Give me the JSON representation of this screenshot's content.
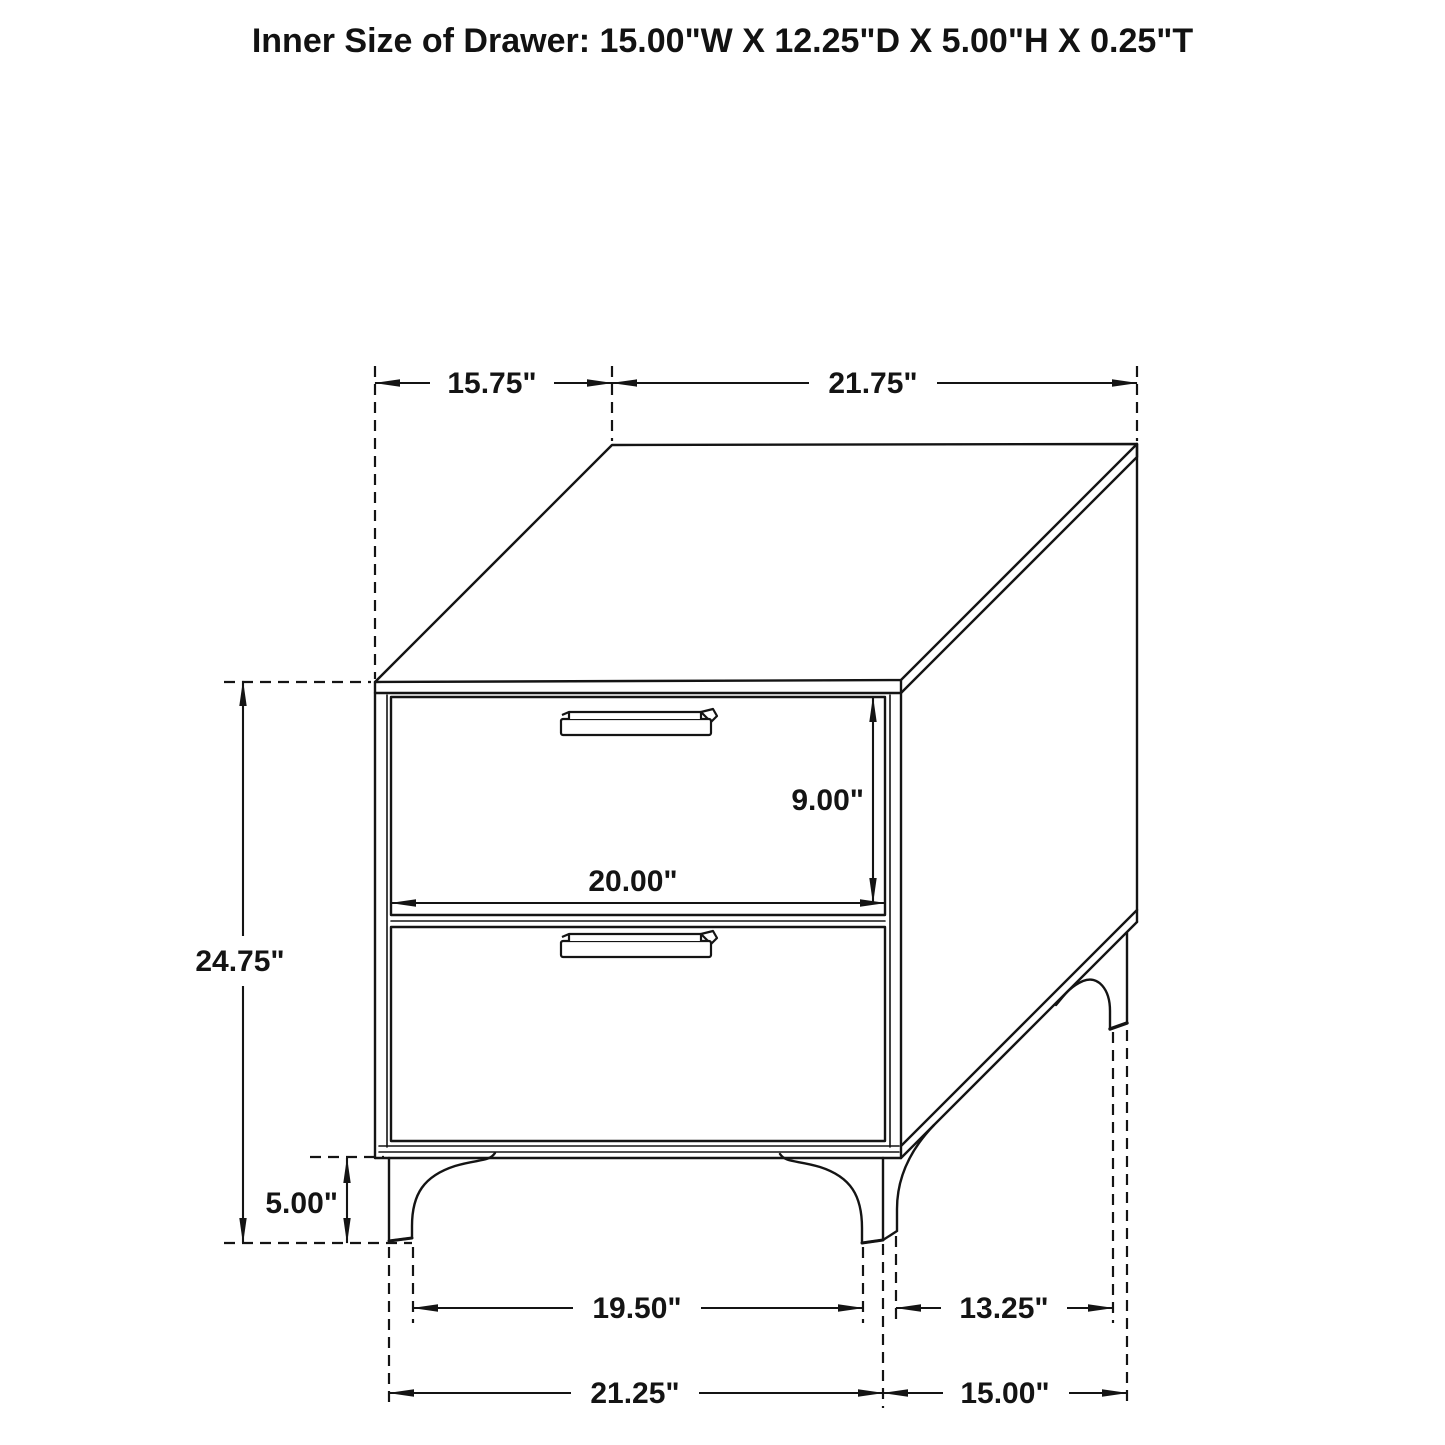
{
  "title": "Inner Size of Drawer: 15.00\"W X 12.25\"D X 5.00\"H X 0.25\"T",
  "dimensions": {
    "top_depth": "15.75\"",
    "top_width": "21.75\"",
    "drawer_face_height": "9.00\"",
    "drawer_face_width": "20.00\"",
    "overall_height": "24.75\"",
    "leg_height": "5.00\"",
    "front_legs_inner_span": "19.50\"",
    "legs_depth_gap": "13.25\"",
    "front_legs_outer_span": "21.25\"",
    "legs_depth_outer_span": "15.00\""
  },
  "colors": {
    "line": "#141414",
    "background": "#ffffff"
  }
}
